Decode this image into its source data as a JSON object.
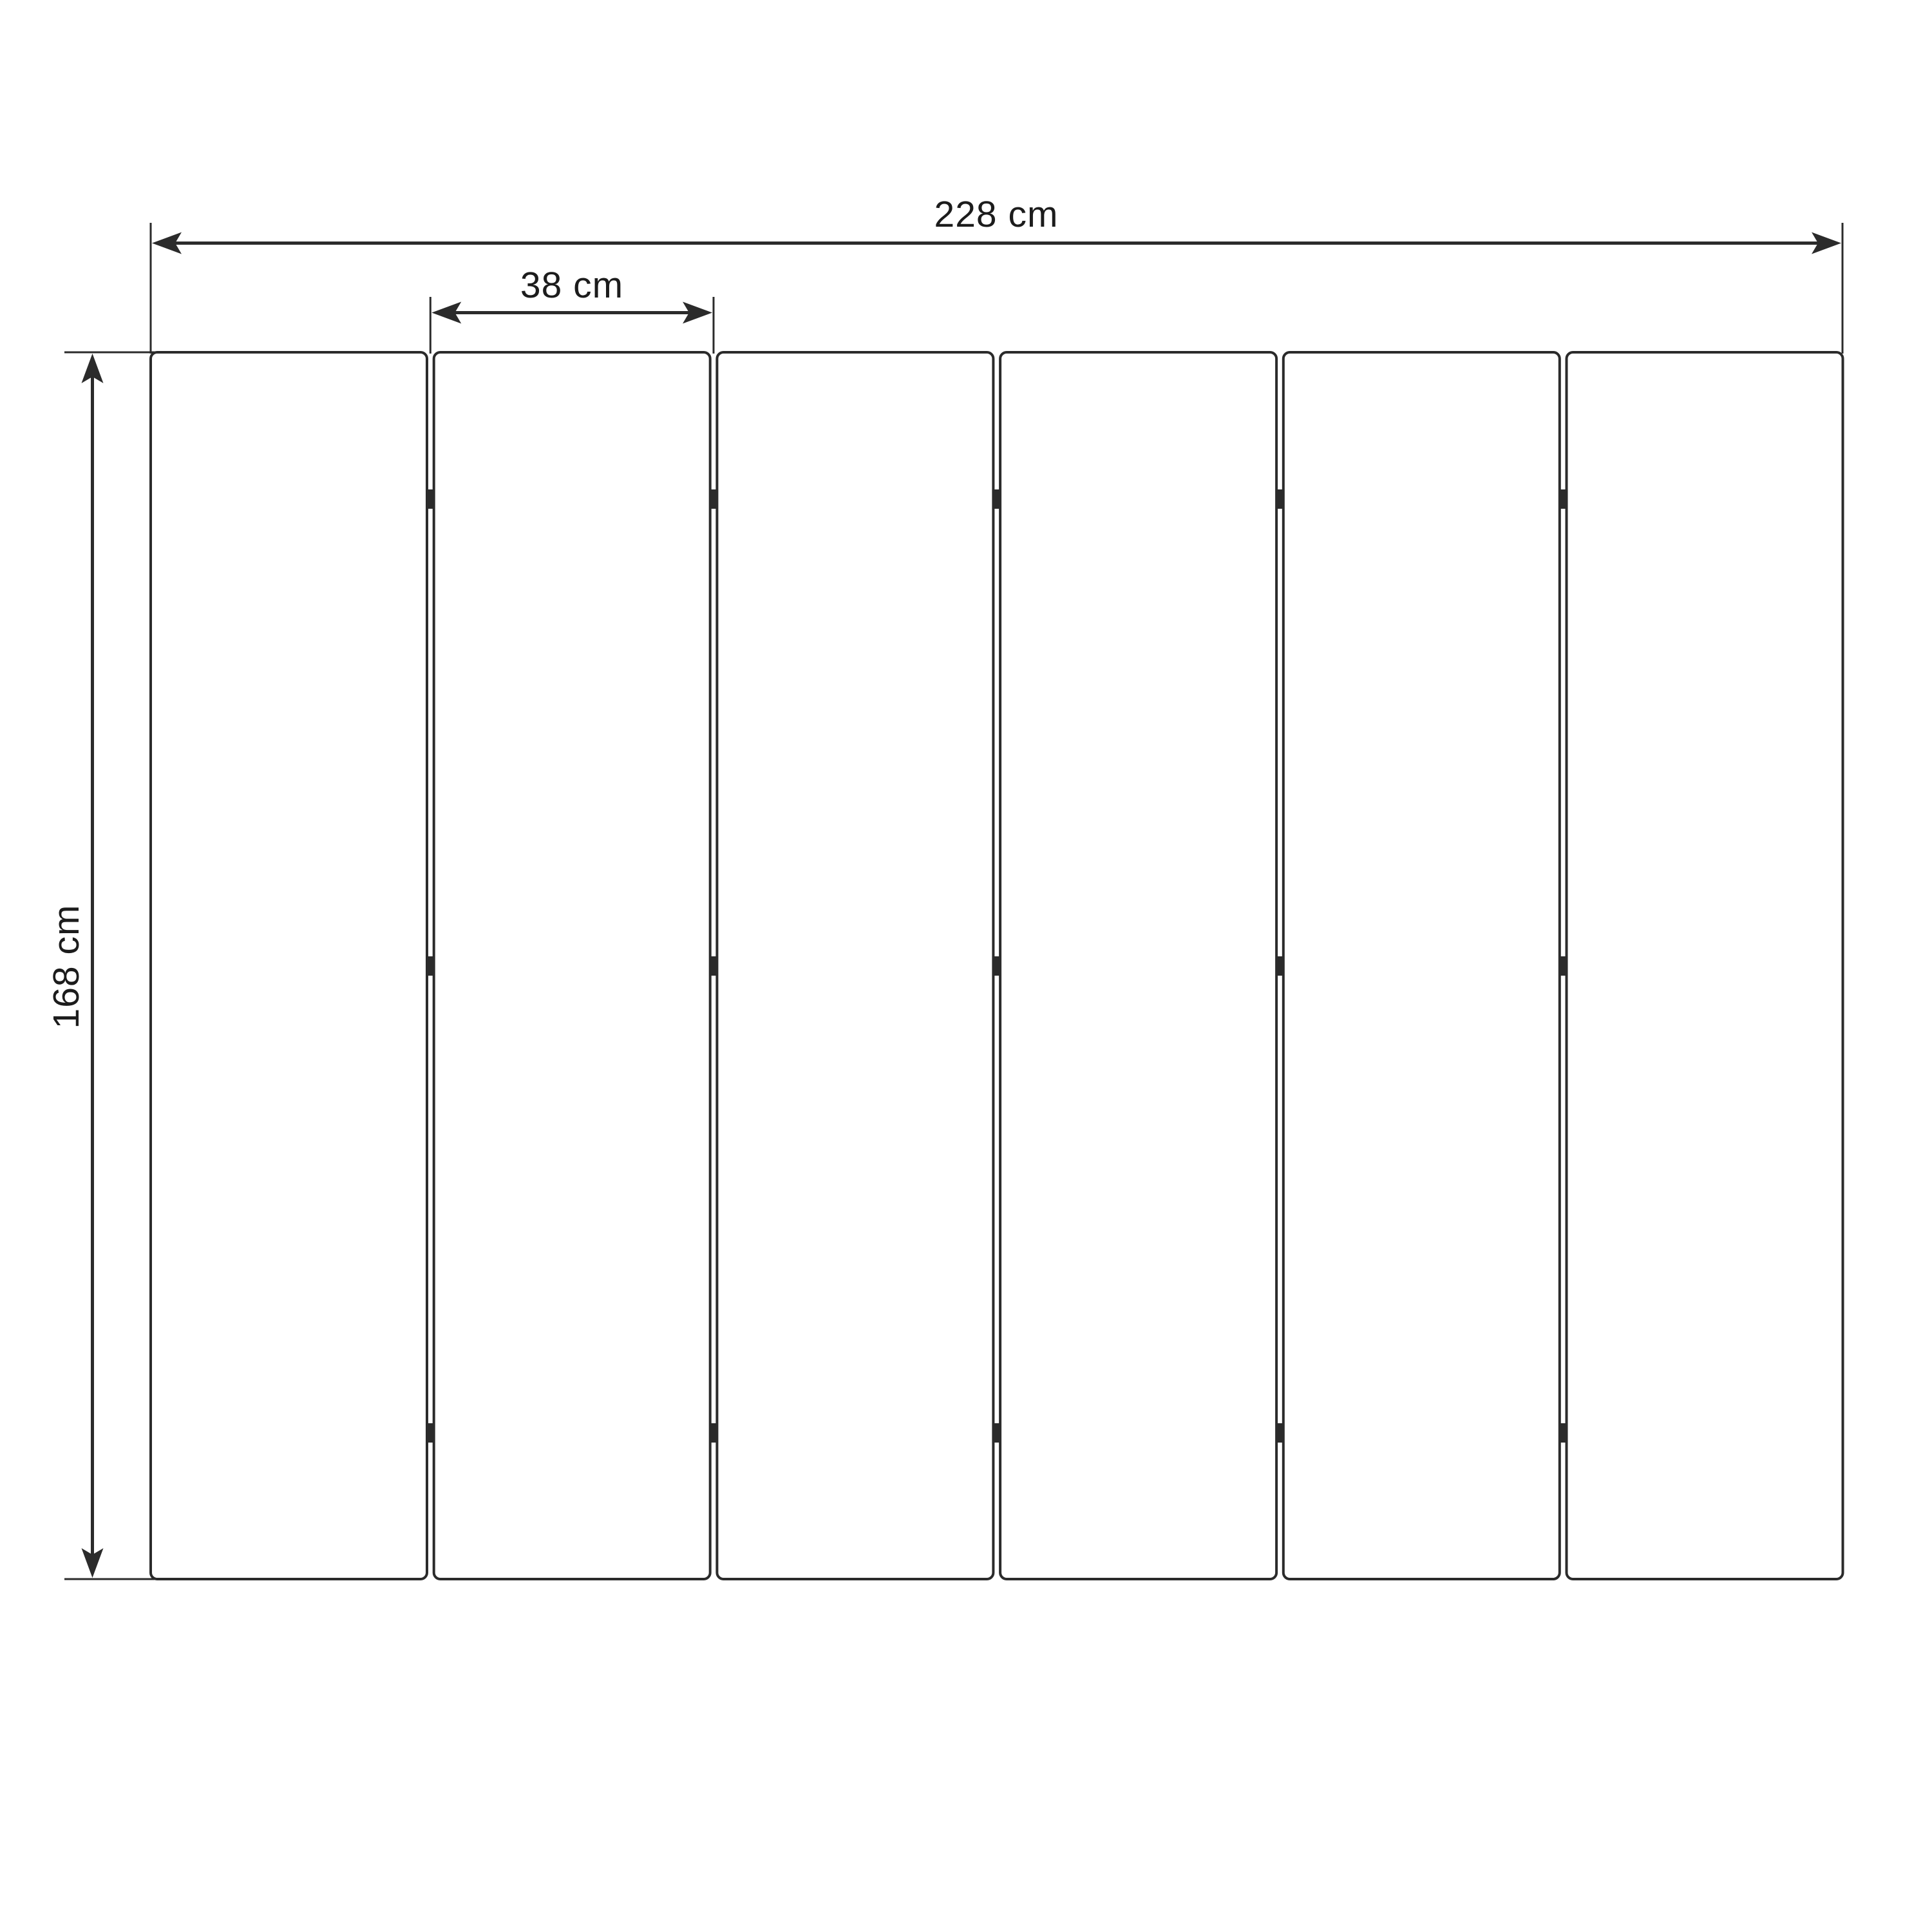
{
  "page": {
    "background": "#ffffff"
  },
  "diagram": {
    "subject": "six-panel-folding-screen-front-view",
    "panel_count": 6,
    "joint_count": 5,
    "hinges_per_joint": 3,
    "line_color": "#2b2b2b",
    "text_color": "#1c1c1c",
    "dimensions": {
      "total_width": {
        "label": "228 cm",
        "value": 228,
        "unit": "cm"
      },
      "panel_width": {
        "label": "38 cm",
        "value": 38,
        "unit": "cm"
      },
      "height": {
        "label": "168 cm",
        "value": 168,
        "unit": "cm"
      }
    }
  }
}
